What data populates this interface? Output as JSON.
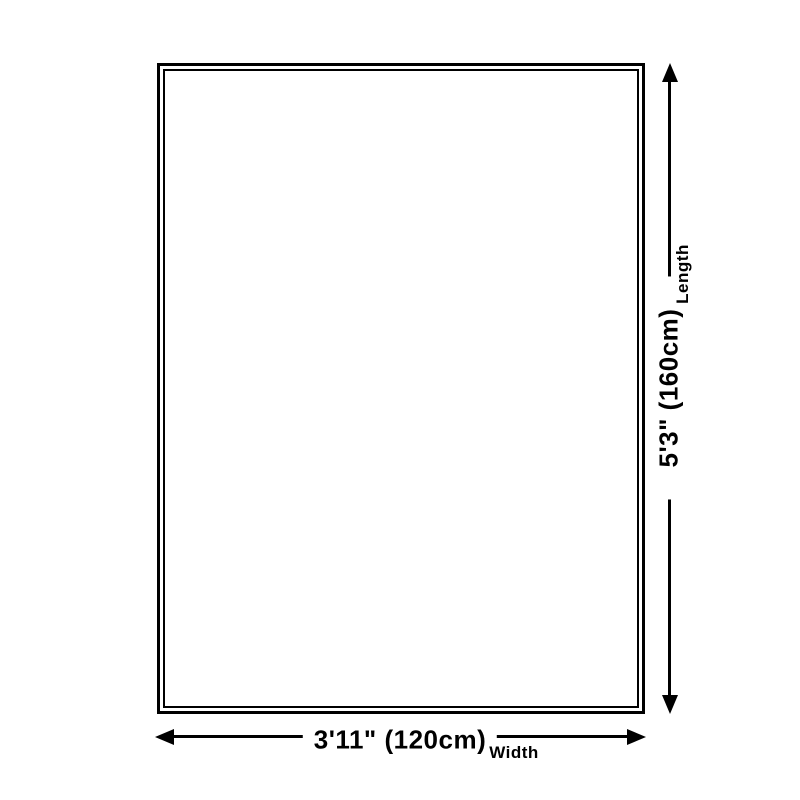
{
  "diagram": {
    "background_color": "#ffffff",
    "line_color": "#000000",
    "text_color": "#000000",
    "shape": "rectangle-double-border",
    "dimensions": {
      "length": {
        "label": "Length",
        "value": "5'3\" (160cm)"
      },
      "width": {
        "label": "Width",
        "value": "3'11\" (120cm)"
      }
    }
  }
}
